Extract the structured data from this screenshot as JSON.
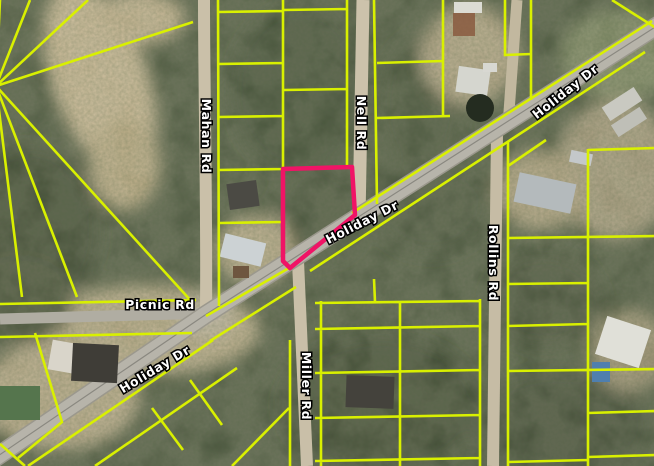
{
  "map": {
    "description": "Aerial parcel map with highlighted lot at Holiday Dr",
    "labels": {
      "holiday_top": "Holiday Dr",
      "holiday_mid": "Holiday Dr",
      "holiday_bottom": "Holiday Dr",
      "mahan": "Mahan Rd",
      "nell": "Nell Rd",
      "rollins": "Rollins Rd",
      "miller": "Miller Rd",
      "picnic": "Picnic Rd"
    },
    "roads": [
      {
        "name": "Holiday Dr",
        "type": "paved",
        "orientation": "diagonal"
      },
      {
        "name": "Mahan Rd",
        "type": "dirt",
        "orientation": "vertical"
      },
      {
        "name": "Nell Rd",
        "type": "dirt",
        "orientation": "vertical"
      },
      {
        "name": "Miller Rd",
        "type": "dirt",
        "orientation": "vertical"
      },
      {
        "name": "Rollins Rd",
        "type": "dirt",
        "orientation": "vertical"
      },
      {
        "name": "Picnic Rd",
        "type": "paved",
        "orientation": "horizontal"
      }
    ],
    "highlight": {
      "points": "283,169 352,167 355,215 290,268 283,261"
    },
    "colors": {
      "parcel_line": "#d9f000",
      "highlight_parcel": "#f01466",
      "label_text": "#ffffff",
      "label_outline": "#000000",
      "paved_road": "#b7b4aa",
      "dirt_road": "#ccc2ab",
      "tree_canopy": "#46513a"
    }
  }
}
